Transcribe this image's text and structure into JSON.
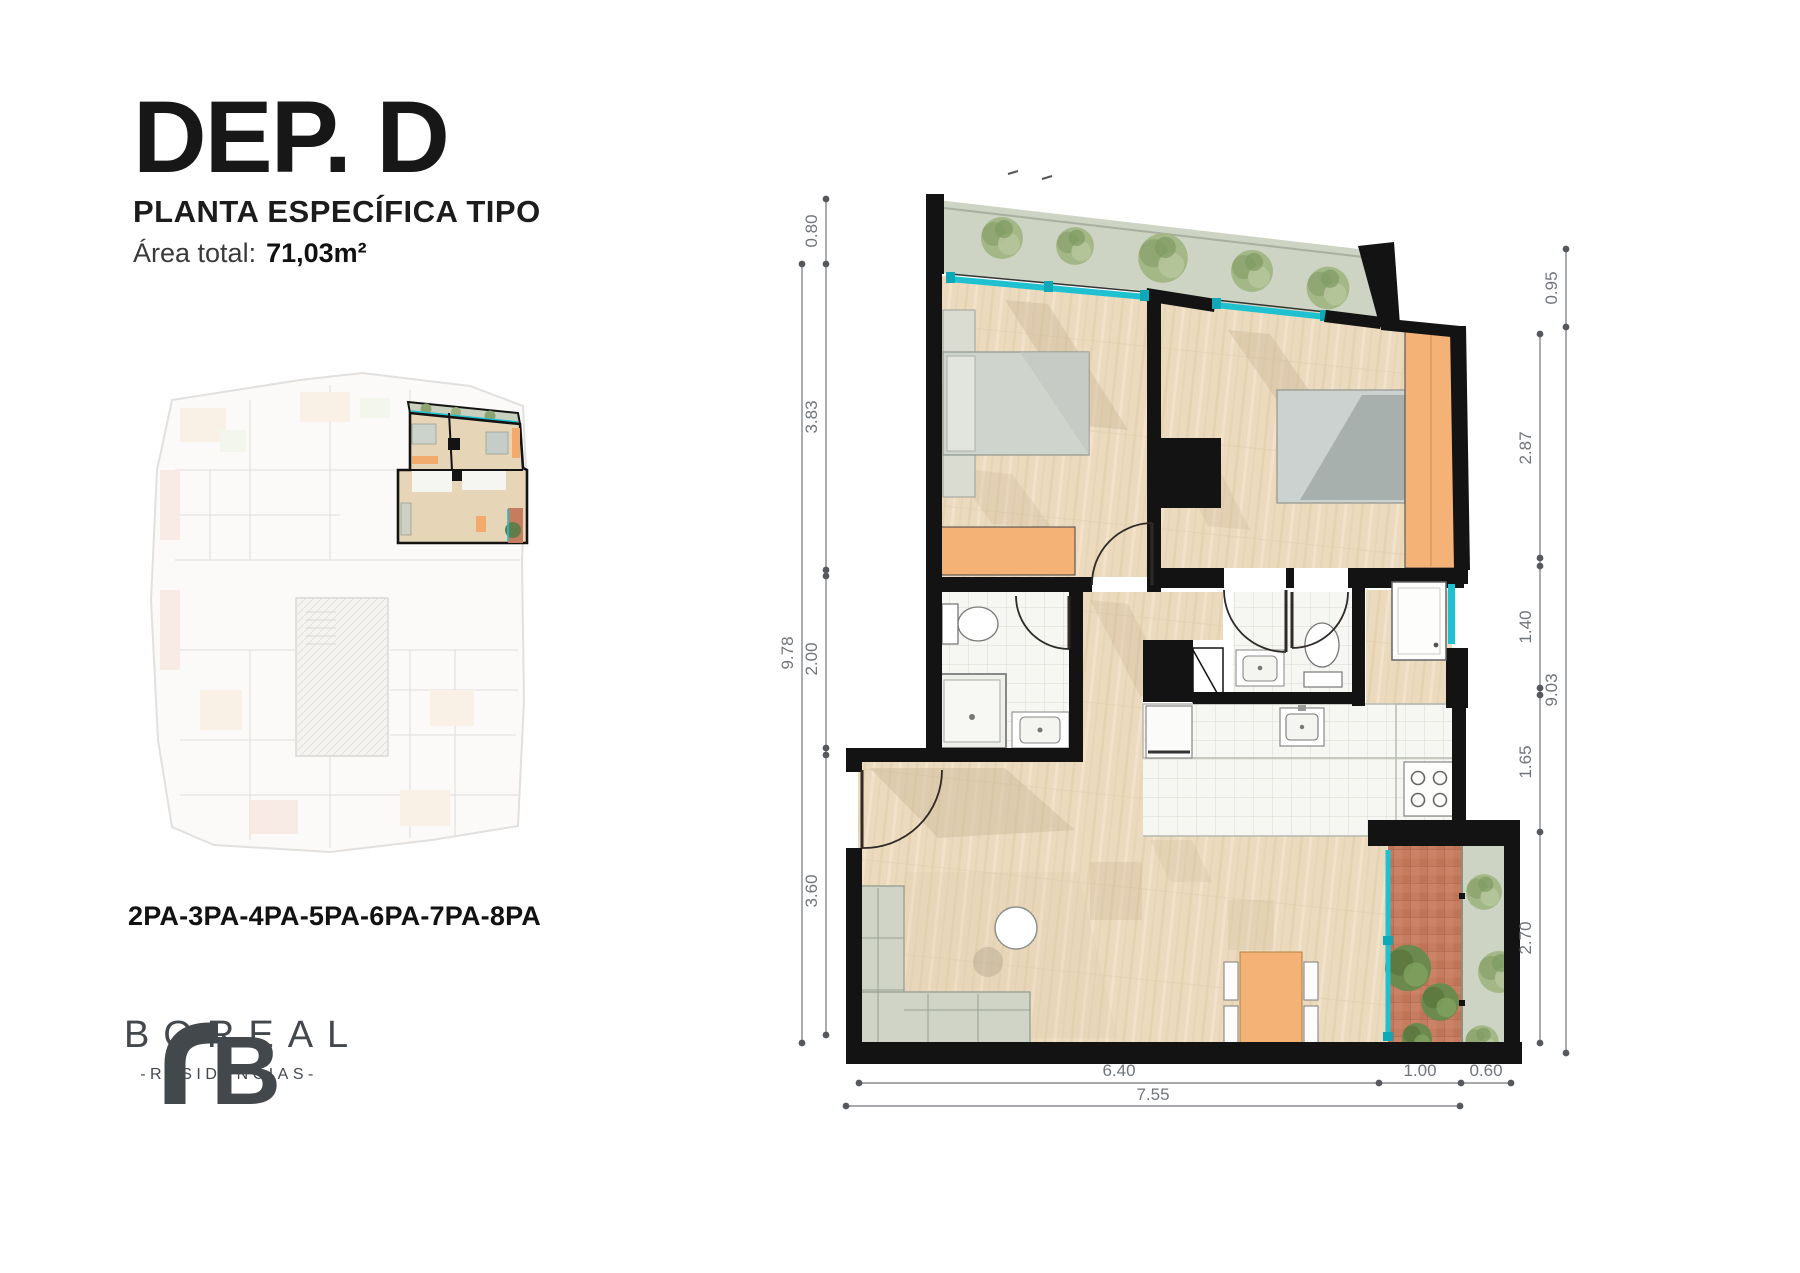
{
  "header": {
    "title": "DEP. D",
    "subtitle": "PLANTA ESPECÍFICA TIPO",
    "area_label": "Área total:",
    "area_value": "71,03m²"
  },
  "units_label": "2PA-3PA-4PA-5PA-6PA-7PA-8PA",
  "logo": {
    "monogram_letter": "B",
    "name": "BOREAL",
    "tagline": "-RESIDENCIAS-"
  },
  "floor_plan": {
    "dims": {
      "left_outer_total": "9.78",
      "left_segments": [
        "0.80",
        "3.83",
        "2.00",
        "3.60"
      ],
      "right_top": "0.95",
      "right_outer_total": "9.03",
      "right_segments": [
        "2.87",
        "1.40",
        "1.65",
        "2.70"
      ],
      "bottom_segments": [
        "6.40",
        "1.00",
        "0.60"
      ],
      "bottom_total": "7.55"
    },
    "colors": {
      "wall": "#131313",
      "floor_wood": "#ecdabf",
      "furniture_orange": "#f5b277",
      "railing_glass": "#1fc0cf",
      "terrace_green": "#ced4c4",
      "tree_green": "#8ea470",
      "balcony_terracotta": "#c67c5f",
      "dimension_text": "#70757a"
    }
  }
}
